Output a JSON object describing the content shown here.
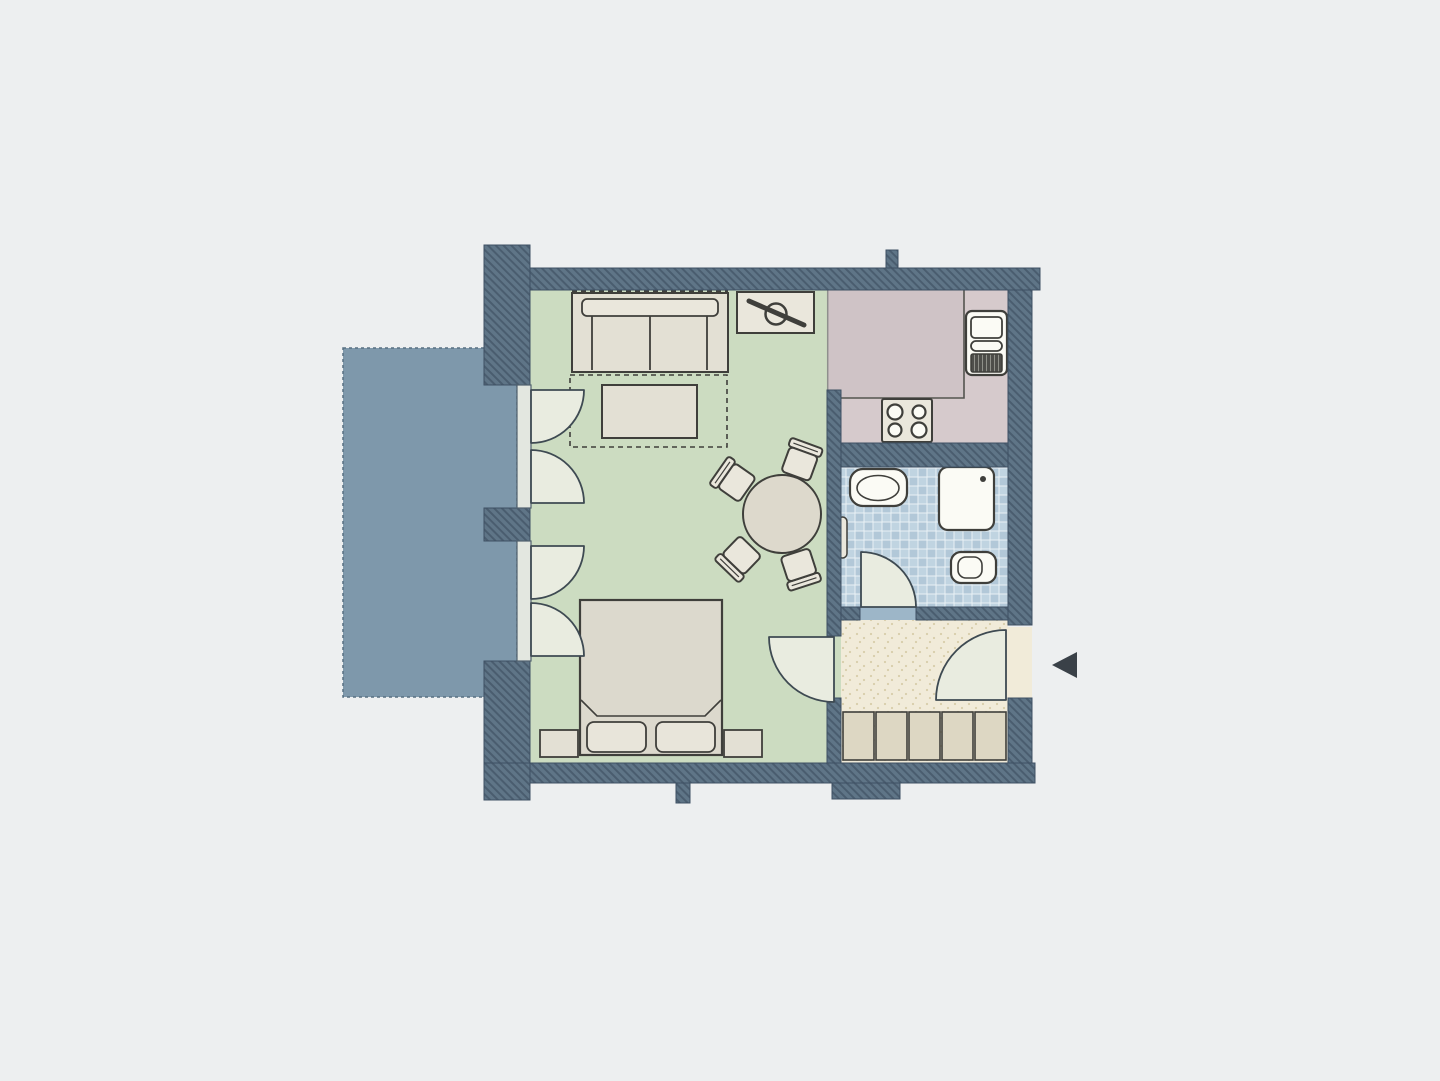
{
  "document": {
    "accessible_title": "Floor plan"
  },
  "colors": {
    "background": "#edeff0",
    "wallBase": "#5f7587",
    "wallHatch": "#4a5d6f",
    "wallEdge": "#3e5063",
    "balcony": "#7e98ab",
    "balconyDash": "#587082",
    "livingFloor": "#ccdcc1",
    "kitchenFloor": "#cfc3c6",
    "kitchenCounter": "#d6cacc",
    "counterEdge": "#54544f",
    "bathTileA": "#c0d4e1",
    "bathTileB": "#b2c8d8",
    "tileLine": "#e9f1f5",
    "hallFloor": "#f1ebd9",
    "hallDot": "#d8cdaa",
    "wardrobe": "#ddd7c3",
    "outline": "#3f3f3b",
    "furniture": "#e3e0d4",
    "furnitureLight": "#eae7dc",
    "bedFill": "#dcd9cd",
    "pillow": "#e8e5da",
    "tableFill": "#ddd9cc",
    "fixture": "#fbfbf5",
    "applianceDark": "#4e4e4a",
    "applianceStripe": "#8f9089",
    "doorLeaf": "#e9ece0",
    "doorStroke": "#3e4a52",
    "thresholdBath": "#9db6c8",
    "boundaryLine": "#8f8f8d",
    "sillFill": "#e3e7e0",
    "sillStroke": "#51616e",
    "arrow": "#3a4148"
  },
  "elements": {
    "rooms": [
      "living-room",
      "kitchen",
      "bathroom",
      "hallway",
      "balcony"
    ],
    "furniture": [
      "sofa",
      "rug",
      "coffee-table",
      "tv-stand",
      "dining-table",
      "dining-chair",
      "double-bed",
      "nightstand",
      "wardrobe"
    ],
    "kitchen_fixtures": [
      "stove-cooktop",
      "kitchen-sink-unit"
    ],
    "bathroom_fixtures": [
      "washbasin",
      "shower",
      "toilet",
      "towel-rail"
    ],
    "doors": [
      "balcony-french-door",
      "bathroom-door",
      "living-room-door",
      "entry-door"
    ],
    "indicators": [
      "entrance-arrow"
    ]
  }
}
